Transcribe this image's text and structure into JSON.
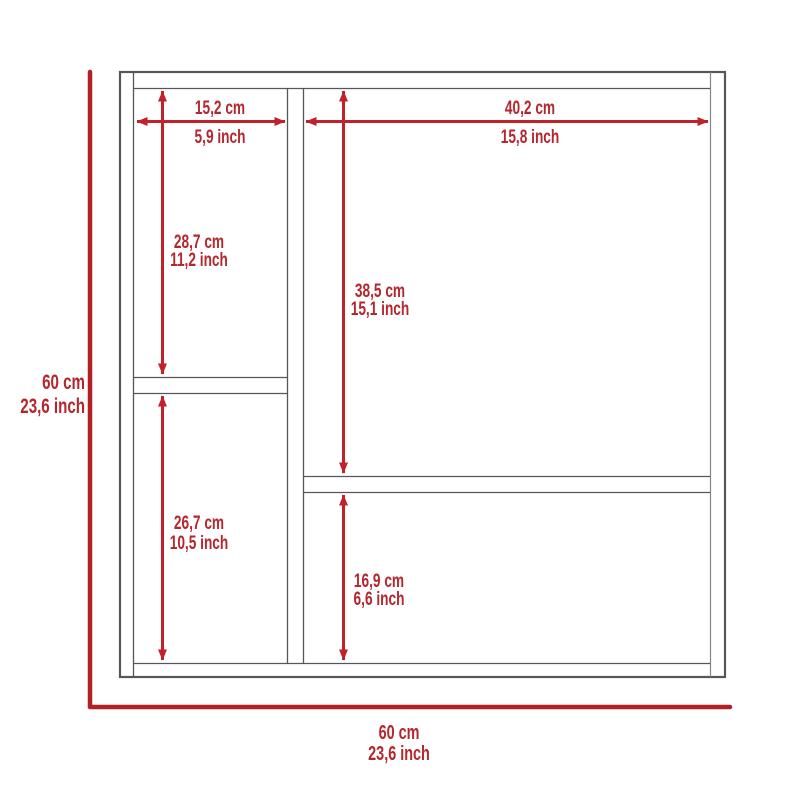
{
  "diagram": {
    "type": "product-dimension-drawing",
    "subject": "cabinet-front-view",
    "colors": {
      "dimension_red": "#c1222a",
      "outline_red": "#b32126",
      "text_red": "#b5262d",
      "frame_gray": "#55565a",
      "background": "#ffffff"
    },
    "dimensions": {
      "left_section_width": {
        "cm": "15,2 cm",
        "inch": "5,9 inch"
      },
      "right_section_width": {
        "cm": "40,2 cm",
        "inch": "15,8 inch"
      },
      "left_upper_height": {
        "cm": "28,7 cm",
        "inch": "11,2 inch"
      },
      "right_upper_height": {
        "cm": "38,5 cm",
        "inch": "15,1 inch"
      },
      "left_lower_height": {
        "cm": "26,7 cm",
        "inch": "10,5 inch"
      },
      "right_lower_height": {
        "cm": "16,9 cm",
        "inch": "6,6 inch"
      },
      "overall_height": {
        "cm": "60 cm",
        "inch": "23,6 inch"
      },
      "overall_width": {
        "cm": "60 cm",
        "inch": "23,6 inch"
      }
    }
  }
}
